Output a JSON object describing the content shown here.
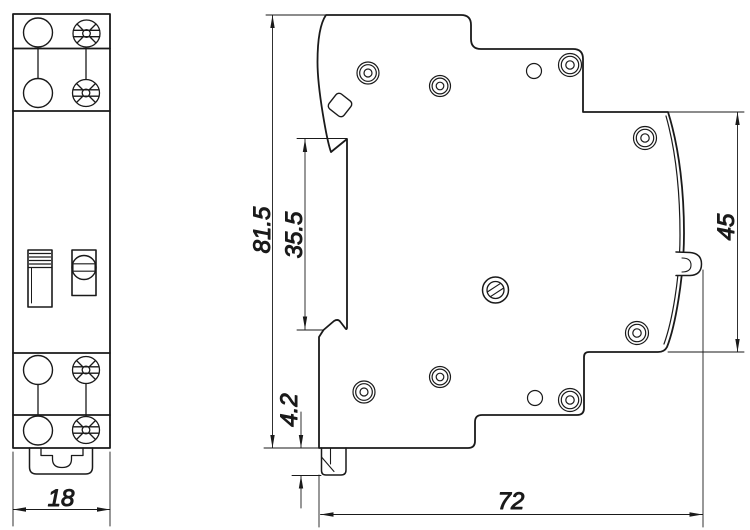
{
  "colors": {
    "background": "#ffffff",
    "line": "#1a1a1a"
  },
  "dimensions": {
    "front_width": {
      "value": "18"
    },
    "overall_height": {
      "value": "81.5"
    },
    "front_recess_height": {
      "value": "35.5"
    },
    "foot_height": {
      "value": "4.2"
    },
    "din_recess_height": {
      "value": "45"
    },
    "overall_depth": {
      "value": "72"
    }
  }
}
